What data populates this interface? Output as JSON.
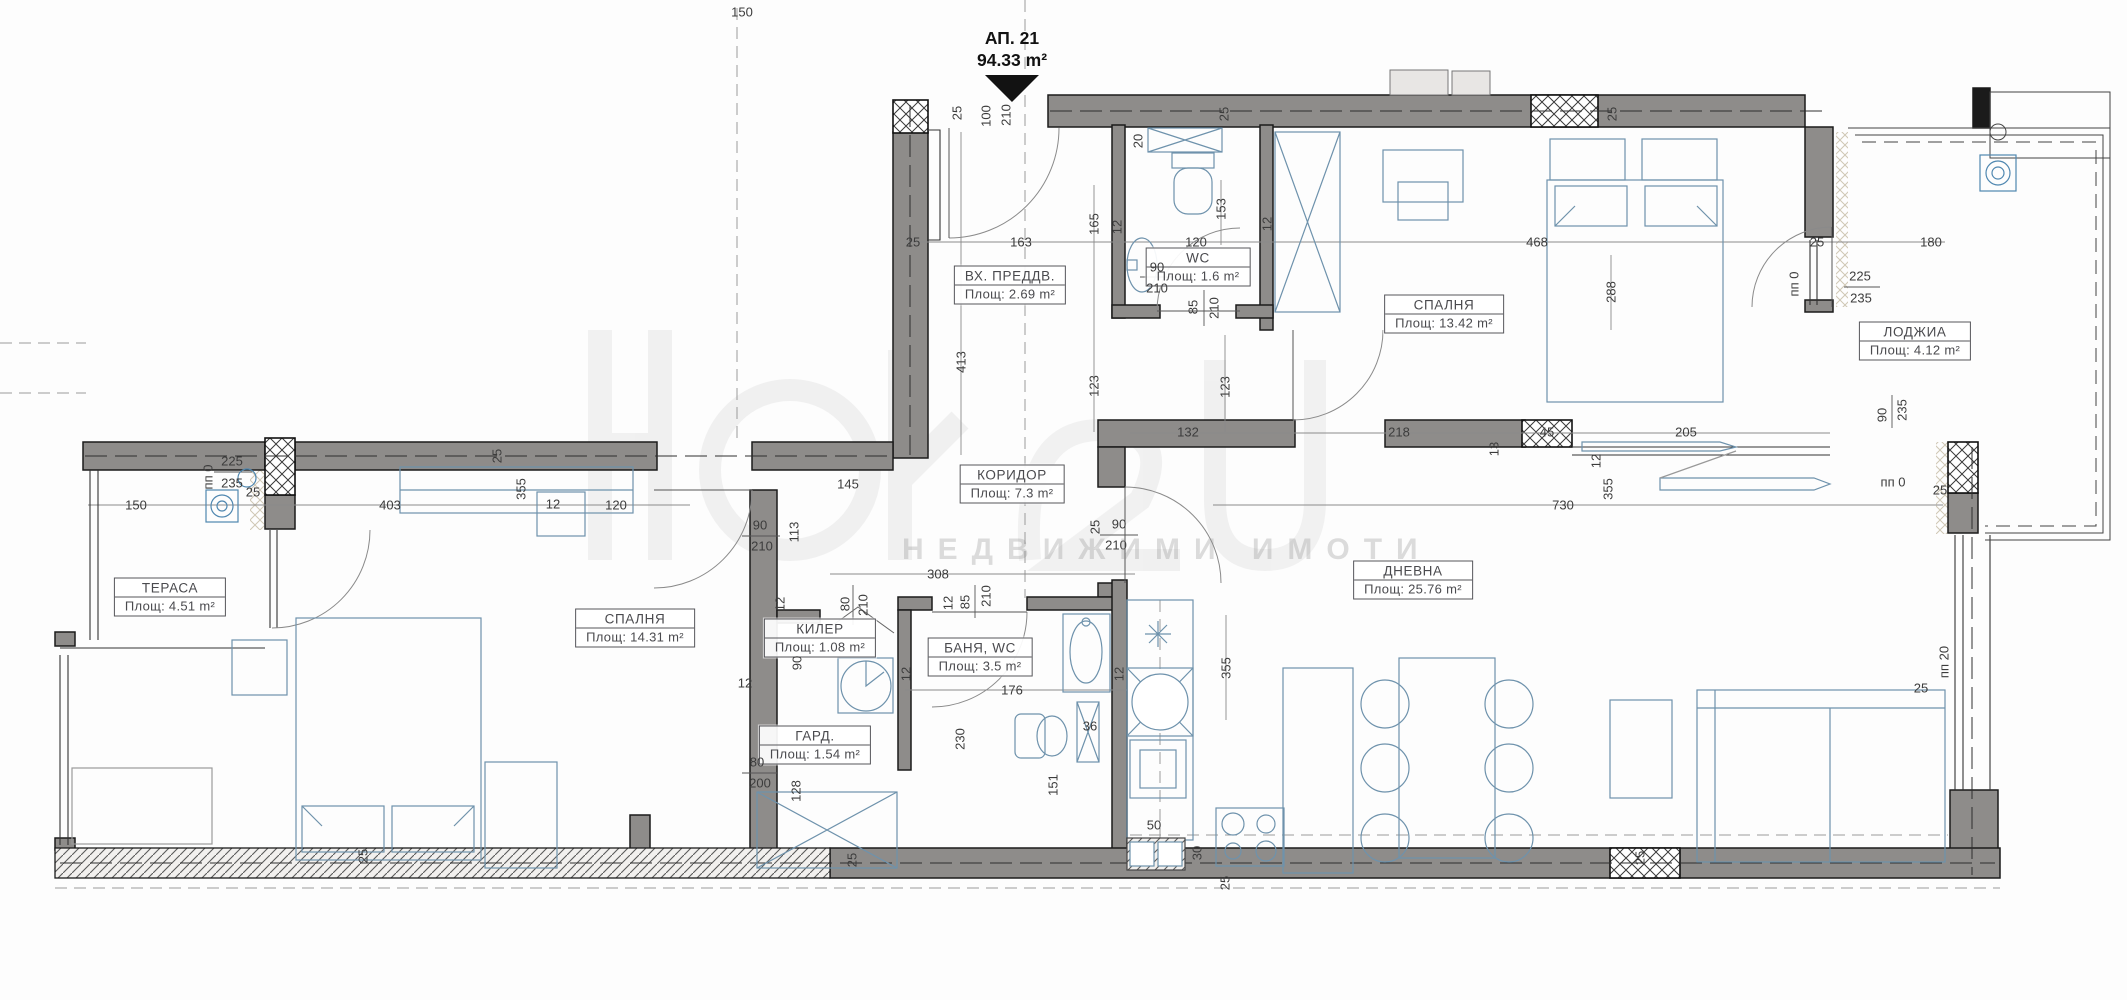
{
  "title": {
    "label": "АП. 21",
    "area": "94.33 m²"
  },
  "watermark": {
    "tagline": "НЕДВИЖИМИ ИМОТИ"
  },
  "colors": {
    "wall_gray": "#8e8c8a",
    "furniture_blue": "#6e92ac",
    "accent_blue": "#4f87b0",
    "line_black": "#1b1b1b"
  },
  "rooms": [
    {
      "name": "ВХ. ПРЕДДВ.",
      "area": "Площ: 2.69 m²",
      "x": 1010,
      "y": 285
    },
    {
      "name": "WC",
      "area": "Площ: 1.6 m²",
      "x": 1198,
      "y": 267
    },
    {
      "name": "СПАЛНЯ",
      "area": "Площ: 13.42 m²",
      "x": 1444,
      "y": 314
    },
    {
      "name": "ЛОДЖИА",
      "area": "Площ: 4.12 m²",
      "x": 1915,
      "y": 341
    },
    {
      "name": "КОРИДОР",
      "area": "Площ: 7.3 m²",
      "x": 1012,
      "y": 484
    },
    {
      "name": "ТЕРАСА",
      "area": "Площ: 4.51 m²",
      "x": 170,
      "y": 597
    },
    {
      "name": "СПАЛНЯ",
      "area": "Площ: 14.31 m²",
      "x": 635,
      "y": 628
    },
    {
      "name": "КИЛЕР",
      "area": "Площ: 1.08 m²",
      "x": 820,
      "y": 638
    },
    {
      "name": "БАНЯ, WC",
      "area": "Площ: 3.5 m²",
      "x": 980,
      "y": 657
    },
    {
      "name": "ГАРД.",
      "area": "Площ: 1.54 m²",
      "x": 815,
      "y": 745
    },
    {
      "name": "ДНЕВНА",
      "area": "Площ: 25.76 m²",
      "x": 1413,
      "y": 580
    }
  ],
  "dimensions": [
    {
      "t": "150",
      "x": 742,
      "y": 12
    },
    {
      "t": "25",
      "x": 957,
      "y": 113,
      "r": 1
    },
    {
      "t": "100",
      "x": 986,
      "y": 116,
      "r": 1
    },
    {
      "t": "210",
      "x": 1006,
      "y": 115,
      "r": 1
    },
    {
      "t": "25",
      "x": 913,
      "y": 242
    },
    {
      "t": "163",
      "x": 1021,
      "y": 242
    },
    {
      "t": "413",
      "x": 961,
      "y": 362,
      "r": 1
    },
    {
      "t": "165",
      "x": 1094,
      "y": 224,
      "r": 1
    },
    {
      "t": "12",
      "x": 1117,
      "y": 227,
      "r": 1
    },
    {
      "t": "20",
      "x": 1138,
      "y": 141,
      "r": 1
    },
    {
      "t": "120",
      "x": 1196,
      "y": 242
    },
    {
      "t": "153",
      "x": 1221,
      "y": 209,
      "r": 1
    },
    {
      "t": "12",
      "x": 1267,
      "y": 224,
      "r": 1
    },
    {
      "t": "25",
      "x": 1224,
      "y": 114,
      "r": 1
    },
    {
      "t": "90",
      "x": 1157,
      "y": 267
    },
    {
      "t": "210",
      "x": 1157,
      "y": 288
    },
    {
      "t": "85",
      "x": 1193,
      "y": 307,
      "r": 1
    },
    {
      "t": "210",
      "x": 1214,
      "y": 308,
      "r": 1
    },
    {
      "t": "468",
      "x": 1537,
      "y": 242
    },
    {
      "t": "25",
      "x": 1612,
      "y": 114,
      "r": 1
    },
    {
      "t": "288",
      "x": 1611,
      "y": 292,
      "r": 1
    },
    {
      "t": "25",
      "x": 1817,
      "y": 242
    },
    {
      "t": "180",
      "x": 1931,
      "y": 242
    },
    {
      "t": "пп 0",
      "x": 1794,
      "y": 284,
      "r": 1
    },
    {
      "t": "225",
      "x": 1860,
      "y": 276
    },
    {
      "t": "235",
      "x": 1861,
      "y": 298
    },
    {
      "t": "90",
      "x": 1882,
      "y": 415,
      "r": 1
    },
    {
      "t": "235",
      "x": 1902,
      "y": 410,
      "r": 1
    },
    {
      "t": "пп 0",
      "x": 1893,
      "y": 482
    },
    {
      "t": "25",
      "x": 497,
      "y": 456,
      "r": 1
    },
    {
      "t": "145",
      "x": 848,
      "y": 484
    },
    {
      "t": "90",
      "x": 760,
      "y": 525
    },
    {
      "t": "210",
      "x": 762,
      "y": 546
    },
    {
      "t": "113",
      "x": 794,
      "y": 532,
      "r": 1
    },
    {
      "t": "123",
      "x": 1094,
      "y": 386,
      "r": 1
    },
    {
      "t": "132",
      "x": 1188,
      "y": 432
    },
    {
      "t": "123",
      "x": 1225,
      "y": 387,
      "r": 1
    },
    {
      "t": "25",
      "x": 1095,
      "y": 527,
      "r": 1
    },
    {
      "t": "90",
      "x": 1119,
      "y": 524
    },
    {
      "t": "210",
      "x": 1116,
      "y": 545
    },
    {
      "t": "308",
      "x": 938,
      "y": 574
    },
    {
      "t": "218",
      "x": 1399,
      "y": 432
    },
    {
      "t": "13",
      "x": 1494,
      "y": 449,
      "r": 1
    },
    {
      "t": "45",
      "x": 1547,
      "y": 432
    },
    {
      "t": "205",
      "x": 1686,
      "y": 432
    },
    {
      "t": "12",
      "x": 1596,
      "y": 461,
      "r": 1
    },
    {
      "t": "пп 0",
      "x": 208,
      "y": 477,
      "r": 1
    },
    {
      "t": "225",
      "x": 232,
      "y": 461
    },
    {
      "t": "235",
      "x": 232,
      "y": 483
    },
    {
      "t": "25",
      "x": 253,
      "y": 492
    },
    {
      "t": "150",
      "x": 136,
      "y": 505
    },
    {
      "t": "403",
      "x": 390,
      "y": 505
    },
    {
      "t": "355",
      "x": 521,
      "y": 489,
      "r": 1
    },
    {
      "t": "12",
      "x": 553,
      "y": 504
    },
    {
      "t": "120",
      "x": 616,
      "y": 505
    },
    {
      "t": "80",
      "x": 845,
      "y": 604,
      "r": 1
    },
    {
      "t": "210",
      "x": 863,
      "y": 605,
      "r": 1
    },
    {
      "t": "12",
      "x": 780,
      "y": 604,
      "r": 1
    },
    {
      "t": "90",
      "x": 797,
      "y": 663,
      "r": 1
    },
    {
      "t": "12",
      "x": 745,
      "y": 683
    },
    {
      "t": "80",
      "x": 757,
      "y": 762
    },
    {
      "t": "200",
      "x": 760,
      "y": 783
    },
    {
      "t": "128",
      "x": 796,
      "y": 791,
      "r": 1
    },
    {
      "t": "12",
      "x": 906,
      "y": 674,
      "r": 1
    },
    {
      "t": "12",
      "x": 948,
      "y": 603,
      "r": 1
    },
    {
      "t": "85",
      "x": 965,
      "y": 602,
      "r": 1
    },
    {
      "t": "210",
      "x": 986,
      "y": 596,
      "r": 1
    },
    {
      "t": "176",
      "x": 1012,
      "y": 690
    },
    {
      "t": "230",
      "x": 960,
      "y": 739,
      "r": 1
    },
    {
      "t": "151",
      "x": 1053,
      "y": 785,
      "r": 1
    },
    {
      "t": "36",
      "x": 1090,
      "y": 726
    },
    {
      "t": "50",
      "x": 1154,
      "y": 825
    },
    {
      "t": "30",
      "x": 1197,
      "y": 853,
      "r": 1
    },
    {
      "t": "355",
      "x": 1226,
      "y": 668,
      "r": 1
    },
    {
      "t": "12",
      "x": 1119,
      "y": 674,
      "r": 1
    },
    {
      "t": "25",
      "x": 1225,
      "y": 883,
      "r": 1
    },
    {
      "t": "355",
      "x": 1608,
      "y": 489,
      "r": 1
    },
    {
      "t": "730",
      "x": 1563,
      "y": 505
    },
    {
      "t": "25",
      "x": 1940,
      "y": 490
    },
    {
      "t": "пп 20",
      "x": 1944,
      "y": 662,
      "r": 1
    },
    {
      "t": "25",
      "x": 1921,
      "y": 688
    },
    {
      "t": "25",
      "x": 363,
      "y": 856,
      "r": 1
    },
    {
      "t": "25",
      "x": 852,
      "y": 860,
      "r": 1
    },
    {
      "t": "25",
      "x": 1640,
      "y": 858,
      "r": 1
    }
  ]
}
